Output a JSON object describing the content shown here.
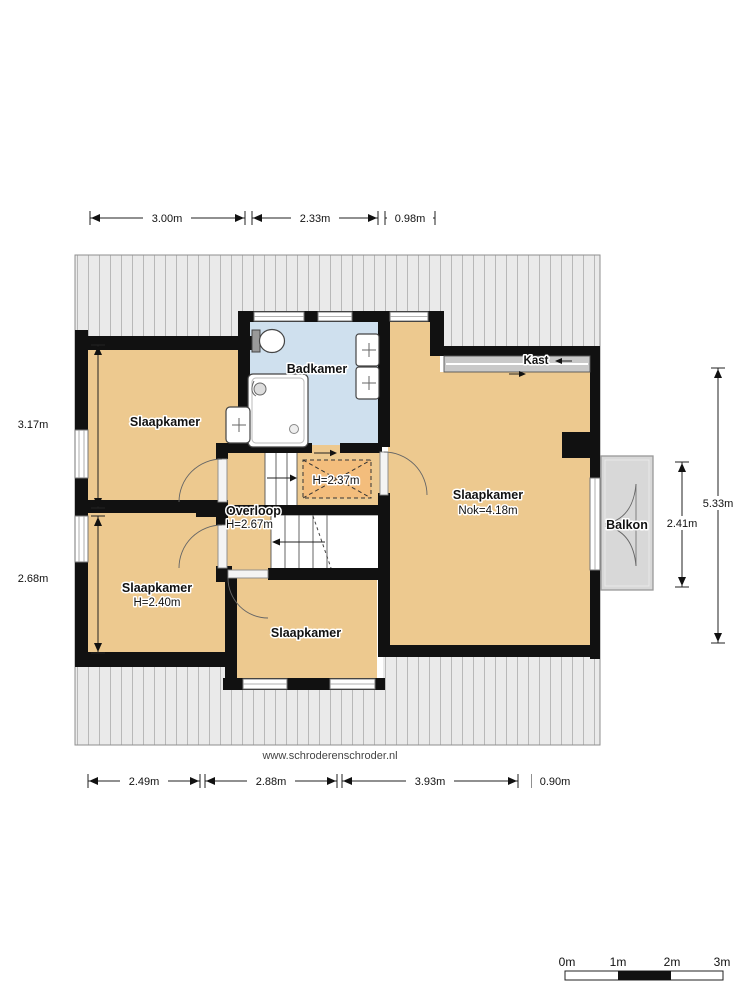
{
  "watermark": {
    "url": "www.schroderenschroder.nl"
  },
  "rooms": {
    "slaapkamer_nw": {
      "label": "Slaapkamer"
    },
    "slaapkamer_sw": {
      "label": "Slaapkamer",
      "height": "H=2.40m"
    },
    "slaapkamer_s": {
      "label": "Slaapkamer"
    },
    "slaapkamer_main": {
      "label": "Slaapkamer",
      "height": "Nok=4.18m"
    },
    "badkamer": {
      "label": "Badkamer"
    },
    "overloop": {
      "label": "Overloop",
      "height": "H=2.67m"
    },
    "low_headroom": {
      "label": "H=2.37m"
    },
    "kast": {
      "label": "Kast"
    },
    "balkon": {
      "label": "Balkon"
    }
  },
  "dimensions": {
    "top": [
      "3.00m",
      "2.33m",
      "0.98m"
    ],
    "bottom": [
      "2.49m",
      "2.88m",
      "3.93m",
      "0.90m"
    ],
    "left": [
      "3.17m",
      "2.68m"
    ],
    "right": [
      "5.33m",
      "2.41m"
    ]
  },
  "scale_bar": {
    "labels": [
      "0m",
      "1m",
      "2m",
      "3m"
    ]
  },
  "icons": [
    "toilet-icon",
    "shower-icon",
    "sink-icon",
    "stairs-up-icon",
    "stairs-down-icon",
    "door-swing-icon",
    "sliding-door-icon"
  ],
  "colors": {
    "floor": "#edc98f",
    "bathroom_floor": "#cfe0ee",
    "low_headroom_floor": "#f3bd7c",
    "balcony_floor": "#d8d8d8",
    "roof": "#eaeaea",
    "wall": "#111111"
  }
}
